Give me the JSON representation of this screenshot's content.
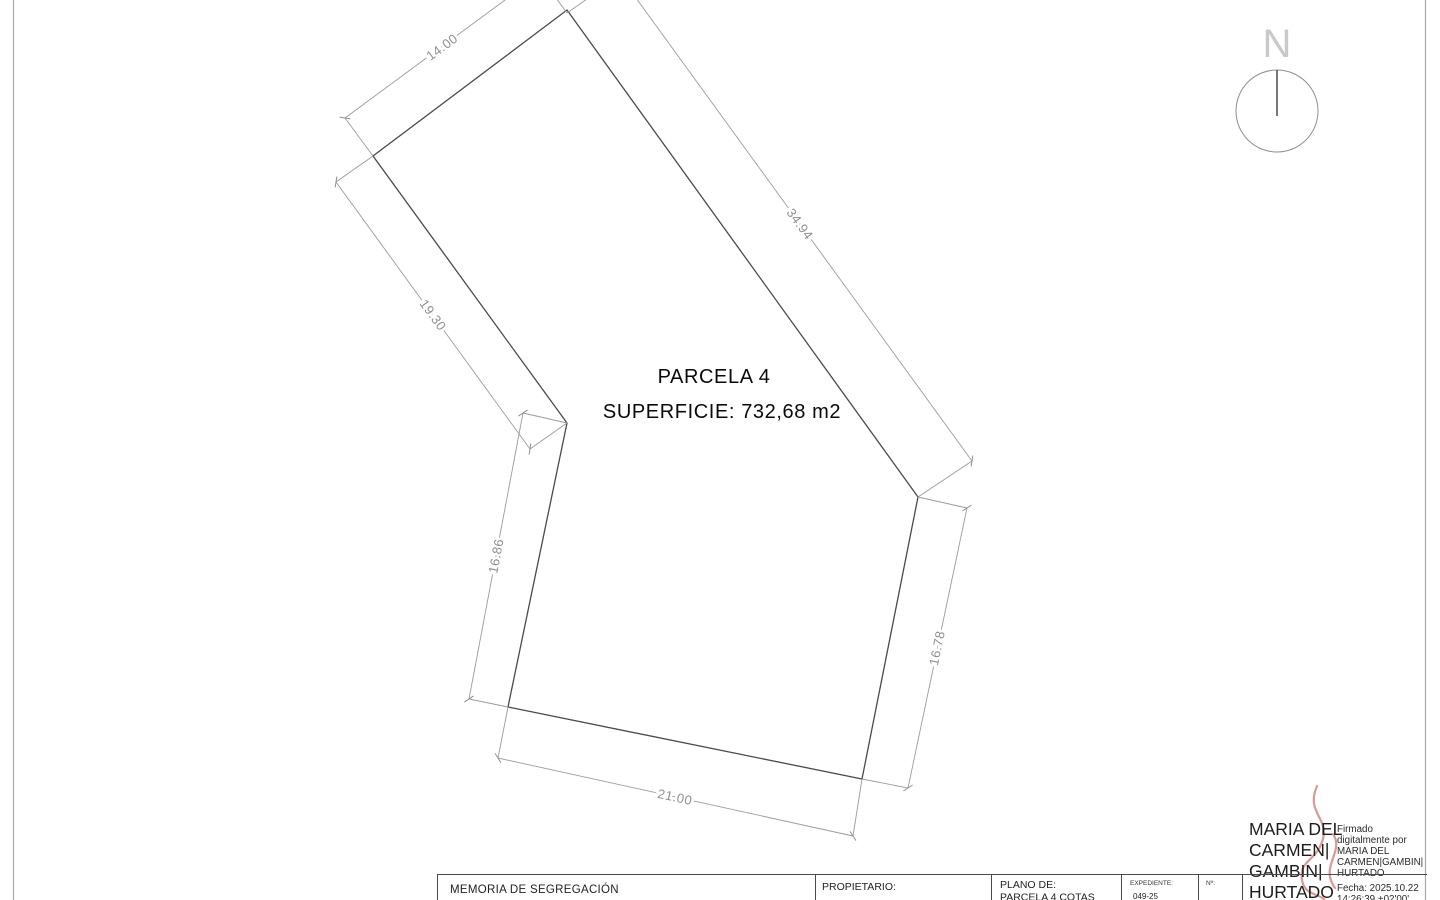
{
  "drawing": {
    "north_label": "N",
    "parcel_label": "PARCELA 4",
    "area_label": "SUPERFICIE: 732,68 m2",
    "dimensions": {
      "top": "14.00",
      "upper_right": "34.94",
      "upper_left": "19.30",
      "lower_left": "16.86",
      "lower_right": "16.78",
      "bottom": "21.00"
    }
  },
  "title_block": {
    "memoria": "MEMORIA DE SEGREGACIÓN",
    "propietario_label": "PROPIETARIO:",
    "plano_label": "PLANO DE:",
    "plano_value": "PARCELA 4 COTAS",
    "expediente_label": "EXPEDIENTE:",
    "expediente_value": "049-25",
    "numero_label": "Nº:"
  },
  "signature": {
    "name_lines": [
      "MARIA DEL",
      "CARMEN|",
      "GAMBIN|",
      "HURTADO"
    ],
    "details_lines": [
      "Firmado",
      "digitalmente por",
      "MARIA DEL",
      "CARMEN|GAMBIN|",
      "HURTADO",
      "Fecha: 2025.10.22",
      "14:26:39 +02'00'"
    ]
  },
  "colors": {
    "ink": "#4a4a4a",
    "dimension_gray": "#9b9b9b",
    "signature_red": "#b5332a"
  }
}
